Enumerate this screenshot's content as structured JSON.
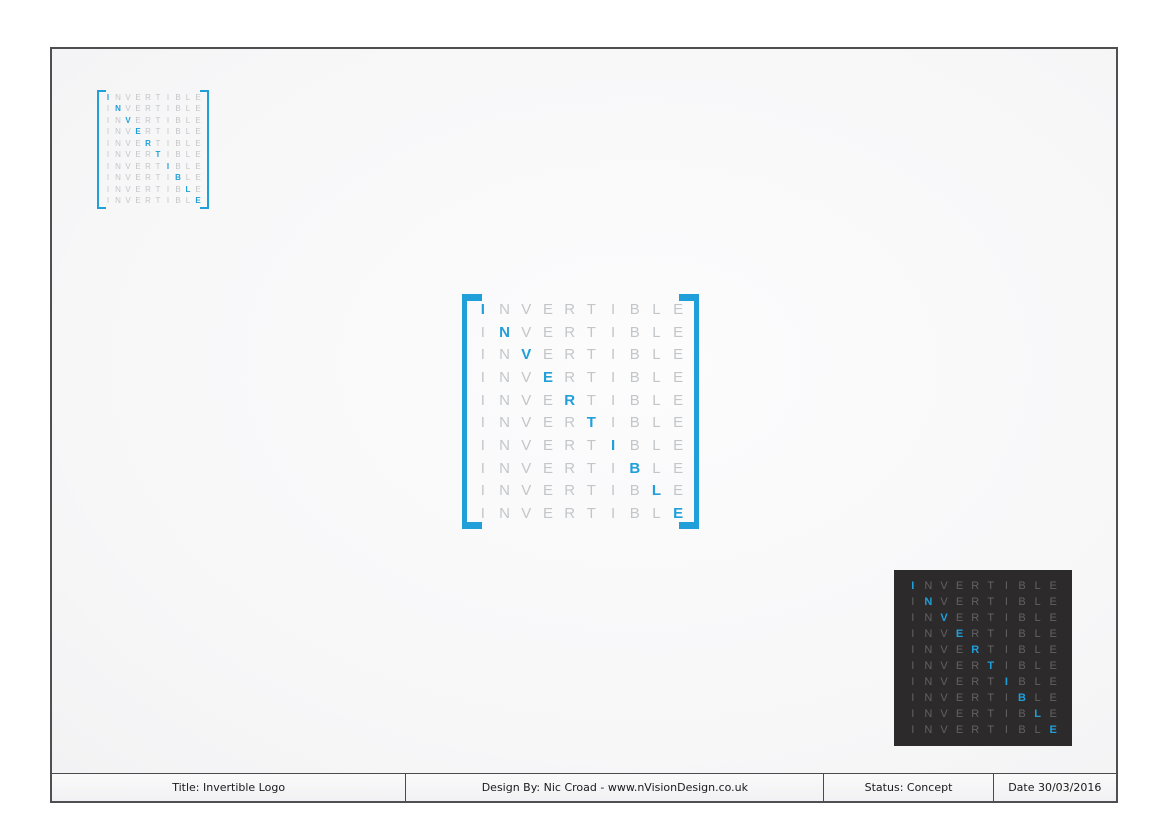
{
  "page": {
    "background_color": "#FFFFFF",
    "sheet_border_color": "#4F4F51"
  },
  "logo": {
    "word": "INVERTIBLE",
    "rows": 10,
    "accent_color": "#219FD9",
    "light_letter_color": "#C3C6C9",
    "dark_letter_color": "#626262",
    "dark_background_color": "#2D2A2B"
  },
  "variants": {
    "small_light": {
      "description": "small light logo with brackets"
    },
    "large_light": {
      "description": "large light logo with brackets"
    },
    "dark": {
      "description": "dark square logo"
    }
  },
  "footer": {
    "title": "Title: Invertible Logo",
    "design_by": "Design By: Nic Croad - www.nVisionDesign.co.uk",
    "status": "Status: Concept",
    "date": "Date 30/03/2016"
  }
}
